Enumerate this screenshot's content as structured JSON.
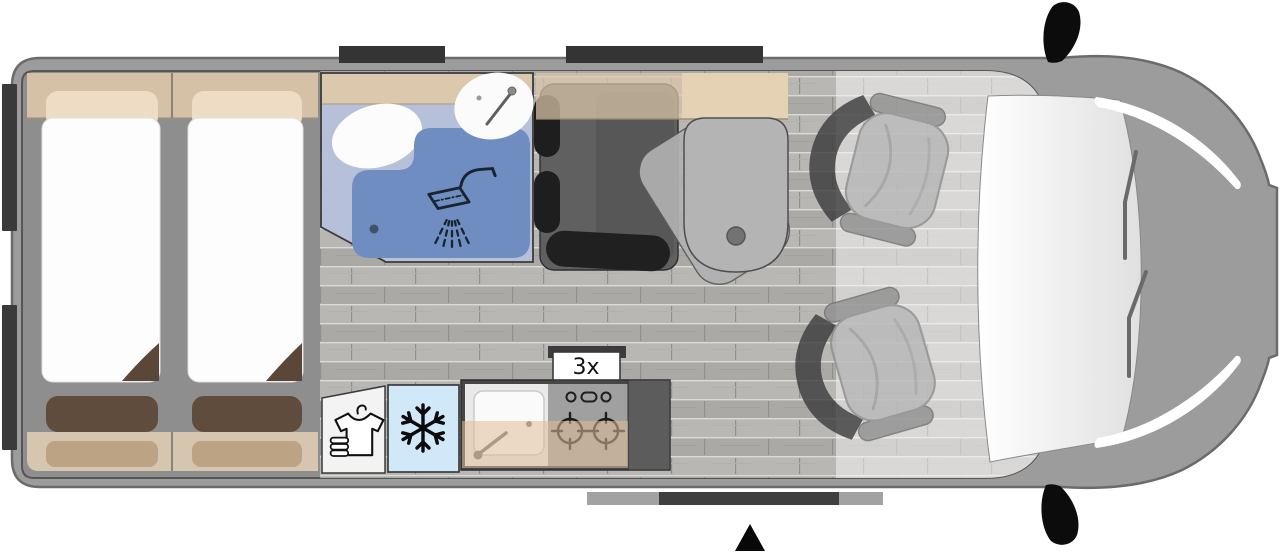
{
  "floorplan": {
    "type": "campervan-top-view",
    "kitchen": {
      "burner_label": "3x"
    },
    "colors": {
      "body_gray": "#9c9c9c",
      "body_outline": "#6b6b6b",
      "interior_gray": "#8e8e8e",
      "floor_wood_light": "#b9b7b4",
      "floor_wood_dark": "#aba9a6",
      "cabinet_tan": "#d5c1a6",
      "pillow_light": "#eedcc4",
      "mattress_white": "#fdfdfd",
      "cushion_brown": "#5e4a3a",
      "bench_overlay_tan": "#b99e7f",
      "bathroom_floor": "#b6c0d8",
      "shower_tray_blue": "#6f8dc0",
      "fixture_white": "#fbfbfb",
      "icon_navy": "#18242f",
      "dinette_gray": "#606060",
      "dinette_black": "#1e1e1e",
      "table_gray": "#b4b4b4",
      "fridge_blue": "#d0e8f8",
      "kitchen_frame": "#474747",
      "counter_tan": "rgba(223,190,152,0.55)",
      "cab_overlay": "rgba(250,250,250,0.5)",
      "marker_dark": "#3a3a3a",
      "mirror_black": "#0c0c0c"
    },
    "icons": [
      "shower-icon",
      "bathroom-faucet-icon",
      "toilet-icon",
      "washbasin-icon",
      "wardrobe-shirt-icon",
      "snowflake-icon",
      "kitchen-sink-icon",
      "kitchen-faucet-icon",
      "stove-knobs-icon",
      "burner-icon",
      "table-leg-icon",
      "entrance-arrow-icon",
      "wing-mirror-icon"
    ],
    "areas": [
      {
        "name": "rear-twin-beds"
      },
      {
        "name": "bathroom-shower"
      },
      {
        "name": "wardrobe"
      },
      {
        "name": "fridge"
      },
      {
        "name": "kitchen-block"
      },
      {
        "name": "dinette-with-table"
      },
      {
        "name": "cab-swivel-seats"
      }
    ]
  }
}
